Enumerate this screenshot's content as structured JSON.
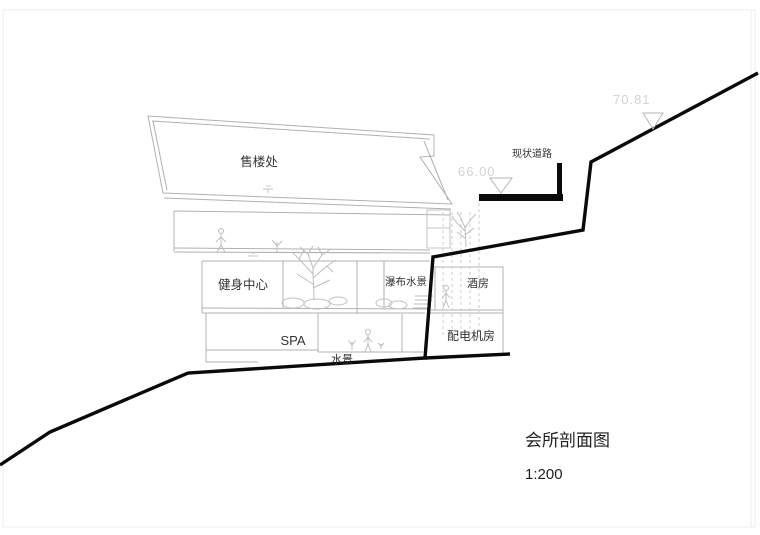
{
  "drawing": {
    "title_block": {
      "title": "会所剖面图",
      "scale": "1:200"
    },
    "road_label": "现状道路",
    "elevations": [
      {
        "name": "upper-road-level",
        "value": "70.81"
      },
      {
        "name": "existing-road-level",
        "value": "66.00"
      }
    ],
    "rooms": [
      {
        "id": "sales-office",
        "label": "售楼处"
      },
      {
        "id": "fitness-center",
        "label": "健身中心"
      },
      {
        "id": "waterfall-water-feature",
        "label": "瀑布水景"
      },
      {
        "id": "wine-room",
        "label": "酒房"
      },
      {
        "id": "spa",
        "label": "SPA"
      },
      {
        "id": "water-feature",
        "label": "水景"
      },
      {
        "id": "power-distribution-room",
        "label": "配电机房"
      }
    ],
    "colors": {
      "terrain_line": "#0a0a0a",
      "building_line": "#b0b0b0",
      "elevation_text": "#d2d2d2",
      "label_text": "#333333",
      "background": "#ffffff"
    }
  }
}
